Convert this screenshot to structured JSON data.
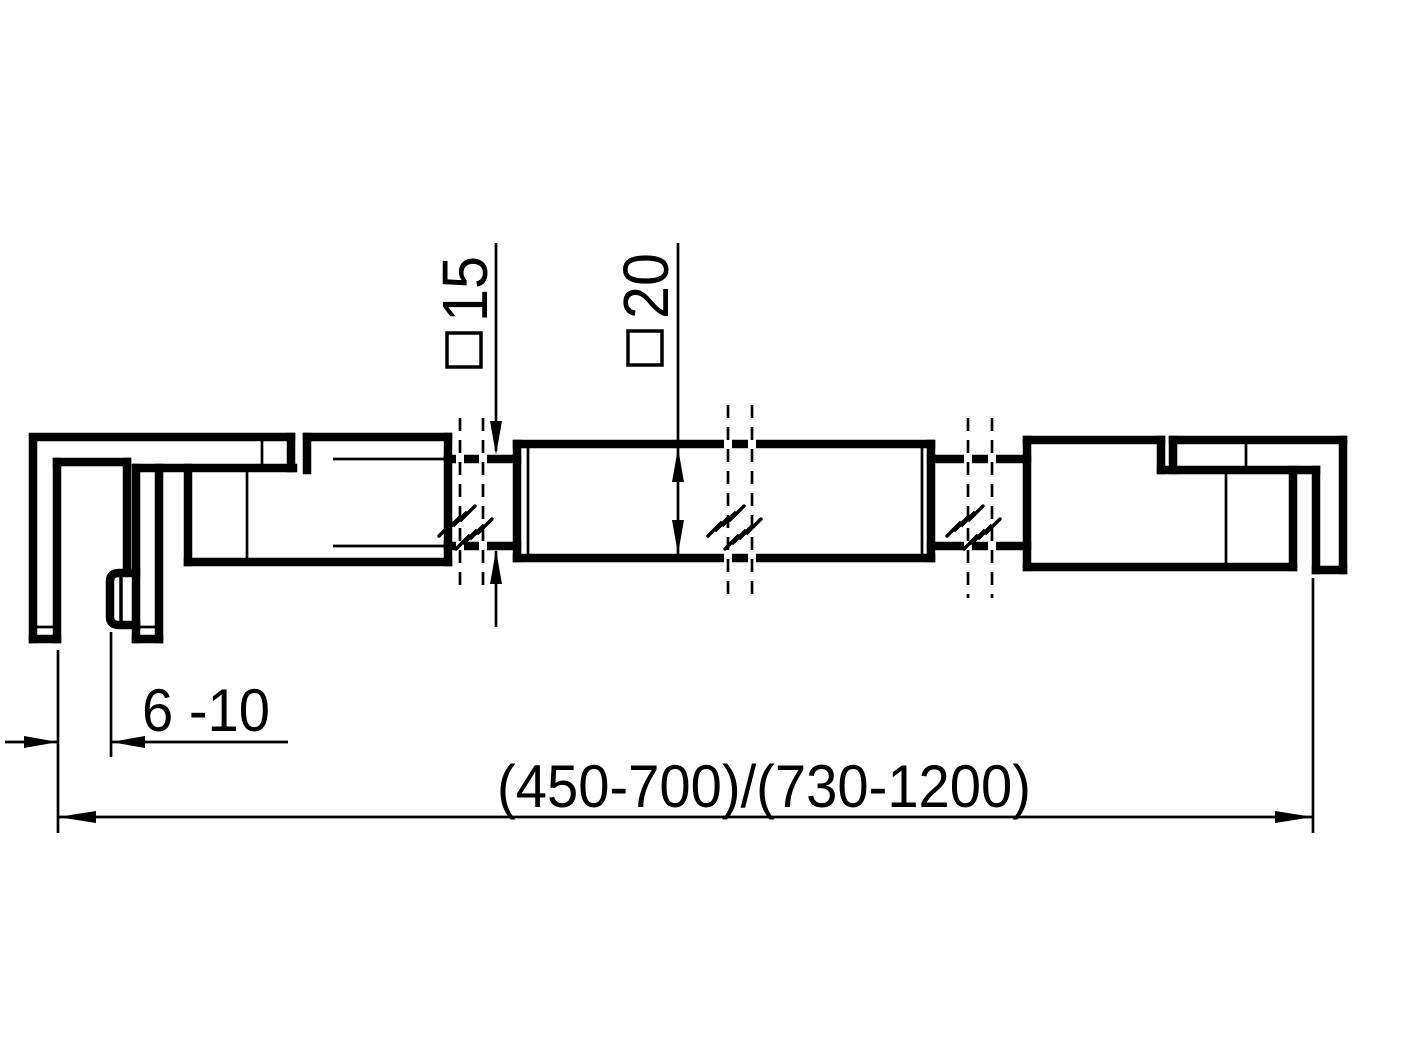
{
  "drawing": {
    "type": "technical-dimension-drawing",
    "subject": "stabilizer-bar-with-glass-clamps-side-view",
    "colors": {
      "line": "#000000",
      "background": "#ffffff"
    },
    "dimensions": {
      "rod_section_label": "15",
      "rod_section_symbol": "square-section",
      "bar_section_label": "20",
      "bar_section_symbol": "square-section",
      "glass_thickness_range": "6 -10",
      "overall_length_range": "(450-700)/(730-1200)"
    }
  }
}
